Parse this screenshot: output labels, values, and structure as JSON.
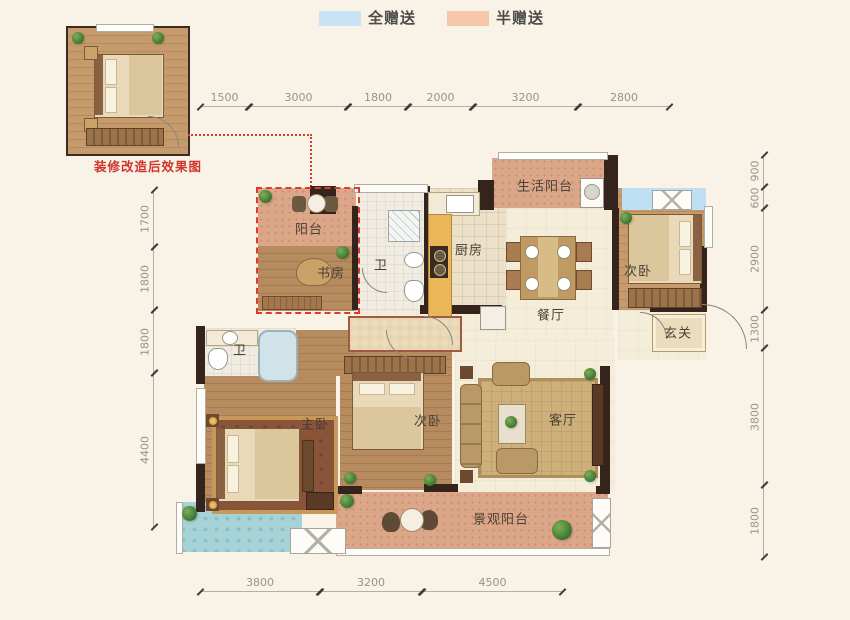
{
  "legend": {
    "items": [
      {
        "label": "全赠送",
        "color": "#c7e3f5"
      },
      {
        "label": "半赠送",
        "color": "#f6c7a9"
      }
    ]
  },
  "inset": {
    "caption": "装修改造后效果图"
  },
  "dimensions": {
    "top": [
      "1500",
      "3000",
      "1800",
      "2000",
      "3200",
      "2800"
    ],
    "bottom": [
      "3800",
      "3200",
      "4500"
    ],
    "left": [
      "1700",
      "1800",
      "1800",
      "4400"
    ],
    "right": [
      "900",
      "600",
      "2900",
      "1300",
      "3800",
      "1800"
    ]
  },
  "rooms": {
    "balcony_top": "阳台",
    "study": "书房",
    "bath_upper": "卫",
    "kitchen": "厨房",
    "service_balcony": "生活阳台",
    "bedroom_tr": "次卧",
    "dining": "餐厅",
    "foyer": "玄关",
    "bath_lower": "卫",
    "master_bedroom": "主卧",
    "bedroom_center": "次卧",
    "living": "客厅",
    "view_balcony": "景观阳台"
  },
  "palette": {
    "background": "#f9f2e6",
    "wall": "#34241b",
    "full_gift_blue": "#c7e3f5",
    "half_gift_salmon": "#f6c7a9",
    "dim_text": "#98938a",
    "label_text": "#4a4034",
    "highlight_red": "#e0392e"
  }
}
